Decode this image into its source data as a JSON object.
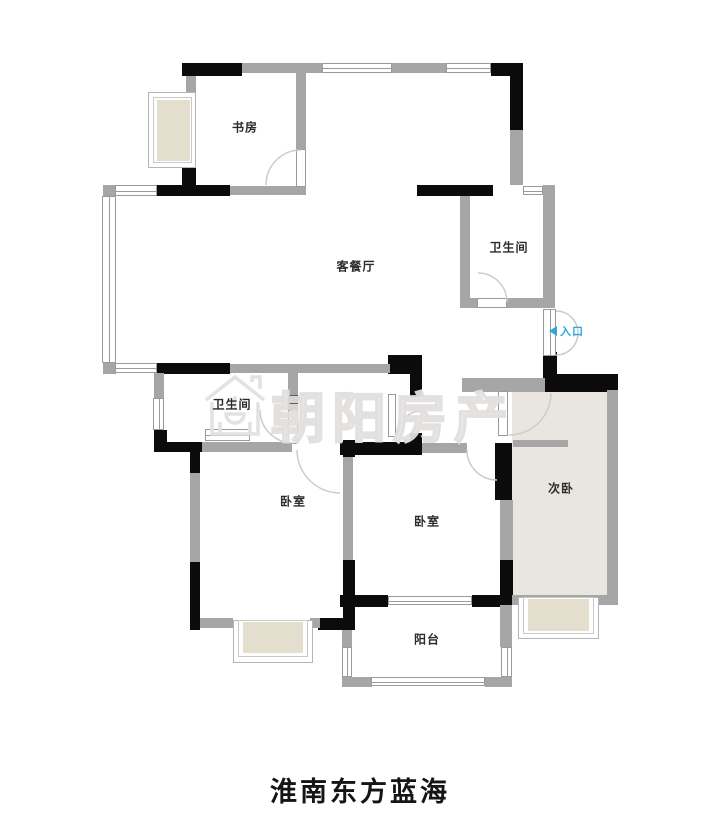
{
  "title": "淮南东方蓝海",
  "watermark": {
    "text": "朝阳房产"
  },
  "entrance": {
    "label": "入口",
    "color": "#2ea7db"
  },
  "rooms": {
    "study": "书房",
    "living_dining": "客餐厅",
    "bathroom_top": "卫生间",
    "bathroom_mid": "卫生间",
    "bedroom_left": "卧室",
    "bedroom_mid": "卧室",
    "bedroom_right": "次卧",
    "balcony": "阳台"
  },
  "colors": {
    "wall_black": "#0b0b0b",
    "wall_gray": "#a6a6a6",
    "room_fill": "#e9e6df",
    "bay_fill": "#e4decf",
    "watermark_gray": "#e2e0de",
    "entrance_blue": "#2ea7db"
  }
}
